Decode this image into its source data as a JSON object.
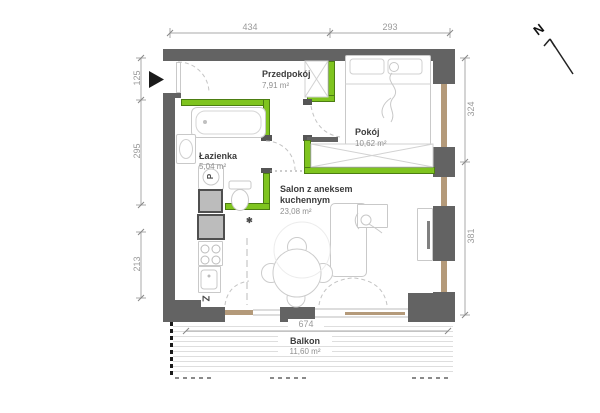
{
  "plan": {
    "rooms": {
      "przedpokoj": {
        "name": "Przedpokój",
        "area": "7,91 m²"
      },
      "pokoj": {
        "name": "Pokój",
        "area": "10,62 m²"
      },
      "lazienka": {
        "name": "Łazienka",
        "area": "5,04 m²"
      },
      "salon": {
        "name_line1": "Salon z aneksem",
        "name_line2": "kuchennym",
        "area": "23,08 m²"
      },
      "balkon": {
        "name": "Balkon",
        "area": "11,60 m²"
      }
    },
    "dimensions": {
      "top_left": "434",
      "top_right": "293",
      "left_upper": "125",
      "left_middle": "295",
      "left_lower": "213",
      "right_upper": "324",
      "right_lower": "381",
      "balcony_width": "674"
    },
    "symbols": {
      "washing_machine": "P",
      "kitchen_unit": "Z",
      "north": "N",
      "footnote": "✱"
    },
    "colors": {
      "wall": "#636363",
      "highlight_green": "#7fc41f",
      "window_frame": "#b49a7a",
      "furniture_stroke": "#c9c9c9",
      "dimension_text": "#9a9a9a",
      "room_name_text": "#3c3c3c"
    }
  }
}
